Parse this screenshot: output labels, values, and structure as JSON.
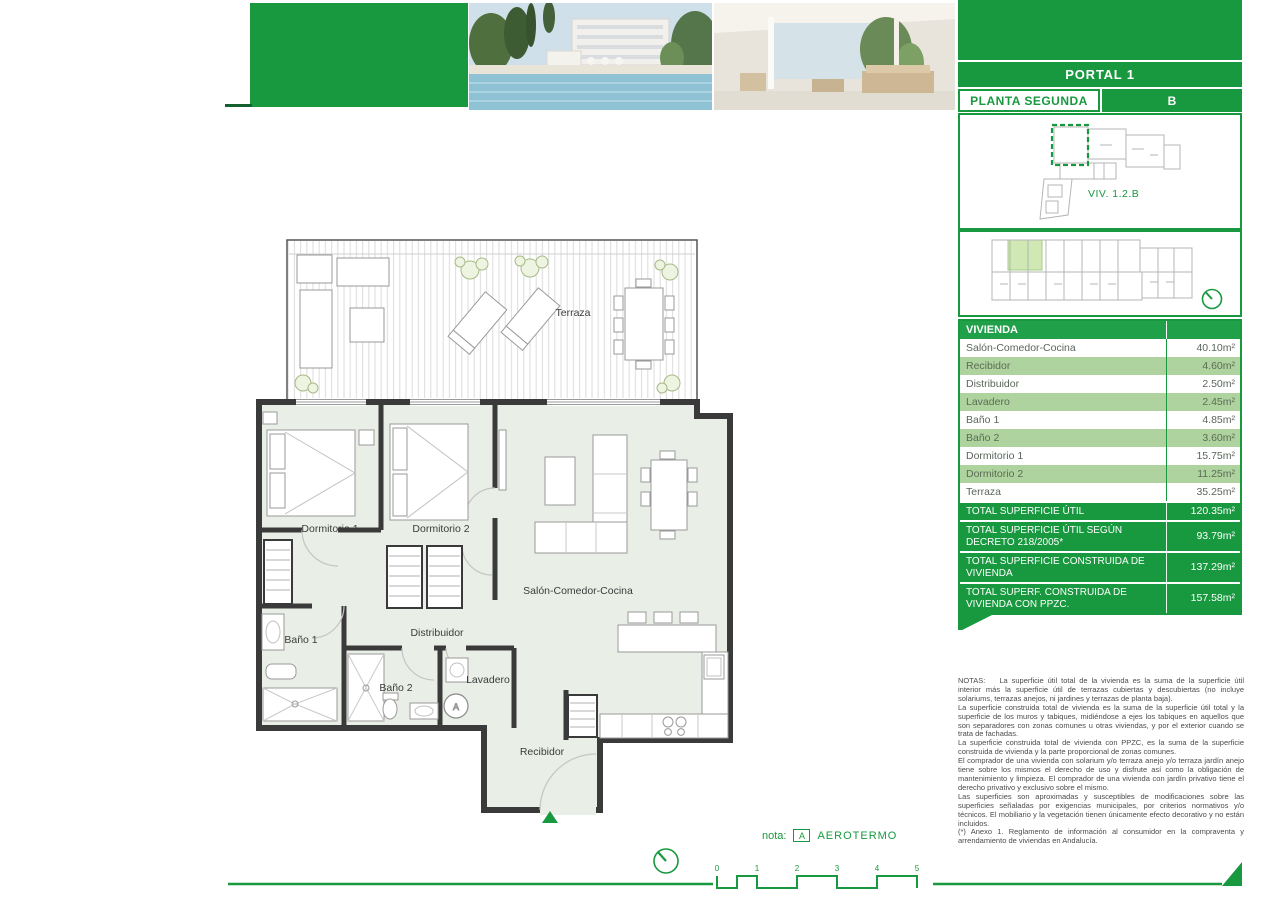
{
  "colors": {
    "brand_green": "#18993f",
    "row_green": "#aed39e",
    "plan_fill": "#e9efe6"
  },
  "sidebar": {
    "portal_label": "PORTAL 1",
    "floor_label": "PLANTA SEGUNDA",
    "unit_letter": "B",
    "unit_ref": "VIV. 1.2.B",
    "areas_table": {
      "header": "VIVIENDA",
      "rows": [
        {
          "label": "Salón-Comedor-Cocina",
          "value": "40.10m²"
        },
        {
          "label": "Recibidor",
          "value": "4.60m²"
        },
        {
          "label": "Distribuidor",
          "value": "2.50m²"
        },
        {
          "label": "Lavadero",
          "value": "2.45m²"
        },
        {
          "label": "Baño 1",
          "value": "4.85m²"
        },
        {
          "label": "Baño 2",
          "value": "3.60m²"
        },
        {
          "label": "Dormitorio 1",
          "value": "15.75m²"
        },
        {
          "label": "Dormitorio 2",
          "value": "11.25m²"
        },
        {
          "label": "Terraza",
          "value": "35.25m²"
        }
      ],
      "totals": [
        {
          "label": "TOTAL SUPERFICIE ÚTIL",
          "value": "120.35m²"
        },
        {
          "label": "TOTAL SUPERFICIE ÚTIL SEGÚN DECRETO 218/2005*",
          "value": "93.79m²"
        },
        {
          "label": "TOTAL SUPERFICIE CONSTRUIDA DE VIVIENDA",
          "value": "137.29m²"
        },
        {
          "label": "TOTAL SUPERF. CONSTRUIDA DE VIVIENDA CON PPZC.",
          "value": "157.58m²"
        }
      ]
    },
    "notes_title": "NOTAS:",
    "notes": [
      "La superficie útil total de la vivienda es la suma de la superficie útil interior más la superficie útil de terrazas cubiertas y descubiertas (no incluye solariums, terrazas anejos, ni jardines y terrazas de planta baja).",
      "La superficie construida total de vivienda es la suma de la superficie útil total y la superficie de los muros y tabiques, midiéndose a ejes los tabiques en aquellos que son separadores con zonas comunes u otras viviendas, y por el exterior cuando se trata de fachadas.",
      "La superficie construida total de vivienda con PPZC, es la suma de la superficie construida de vivienda y la parte proporcional de zonas comunes.",
      "El comprador de una vivienda con solarium y/o terraza anejo y/o terraza jardín anejo tiene sobre los mismos el derecho de uso y disfrute así como la obligación de mantenimiento y limpieza. El comprador de una vivienda con jardín privativo tiene el derecho privativo y exclusivo sobre el mismo.",
      "Las superficies son aproximadas y susceptibles de modificaciones sobre las superficies señaladas por exigencias municipales, por criterios normativos y/o técnicos. El mobiliario y la vegetación tienen únicamente efecto decorativo y no están incluidos.",
      "(*) Anexo 1. Reglamento de información al consumidor en la compraventa y arrendamiento de viviendas en Andalucía."
    ]
  },
  "plan": {
    "room_labels": {
      "terraza": "Terraza",
      "dormitorio1": "Dormitorio 1",
      "dormitorio2": "Dormitorio 2",
      "salon": "Salón-Comedor-Cocina",
      "distribuidor": "Distribuidor",
      "bano1": "Baño 1",
      "bano2": "Baño 2",
      "lavadero": "Lavadero",
      "recibidor": "Recibidor"
    },
    "aerotermo_marker": "A"
  },
  "footer": {
    "note_label": "nota:",
    "aerotermo_abbr": "A",
    "aerotermo_label": "AEROTERMO",
    "scale_ticks": [
      "0",
      "1",
      "2",
      "3",
      "4",
      "5"
    ]
  }
}
